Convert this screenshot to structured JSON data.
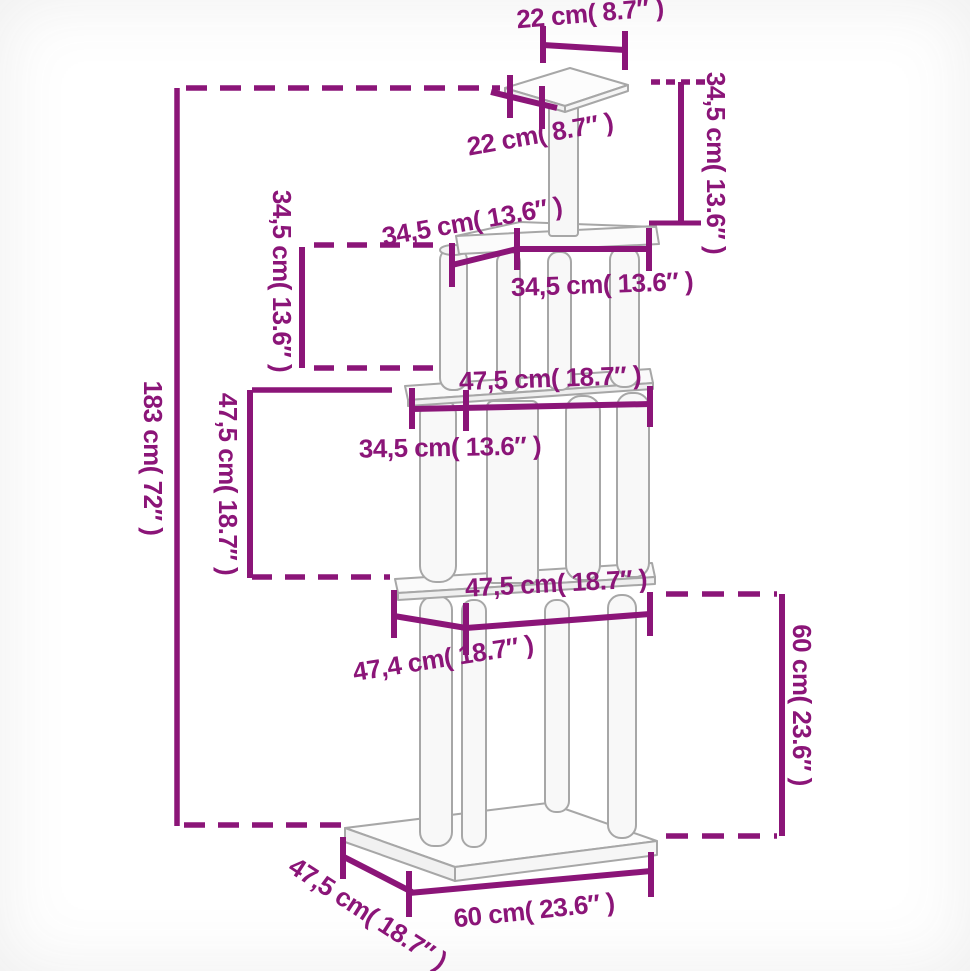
{
  "diagram": {
    "subject": "cat tree with scratching posts - dimension drawing",
    "colors": {
      "dimension_accent": "#8B1578",
      "drawing_outline": "#A7A7A7"
    },
    "measurements": {
      "top_platform_depth": "22 cm( 8.7″ )",
      "top_post_height": "34,5 cm( 13.6″ )",
      "top_platform_width": "22 cm( 8.7″ )",
      "upper_tier_width_slanted": "34,5 cm( 13.6″ )",
      "upper_tier_height": "34,5 cm( 13.6″ )",
      "upper_platform_width": "34,5 cm( 13.6″ )",
      "total_height": "183 cm( 72″ )",
      "middle_tier_height": "47,5 cm( 18.7″ )",
      "middle_platform_width": "47,5 cm( 18.7″ )",
      "middle_platform_inner_width": "34,5 cm( 13.6″ )",
      "lower_platform_width": "47,5 cm( 18.7″ )",
      "lower_platform_inner_width": "47,4 cm( 18.7″ )",
      "base_tier_height": "60 cm( 23.6″ )",
      "base_depth": "47,5 cm( 18.7″ )",
      "base_width": "60 cm( 23.6″ )"
    }
  }
}
